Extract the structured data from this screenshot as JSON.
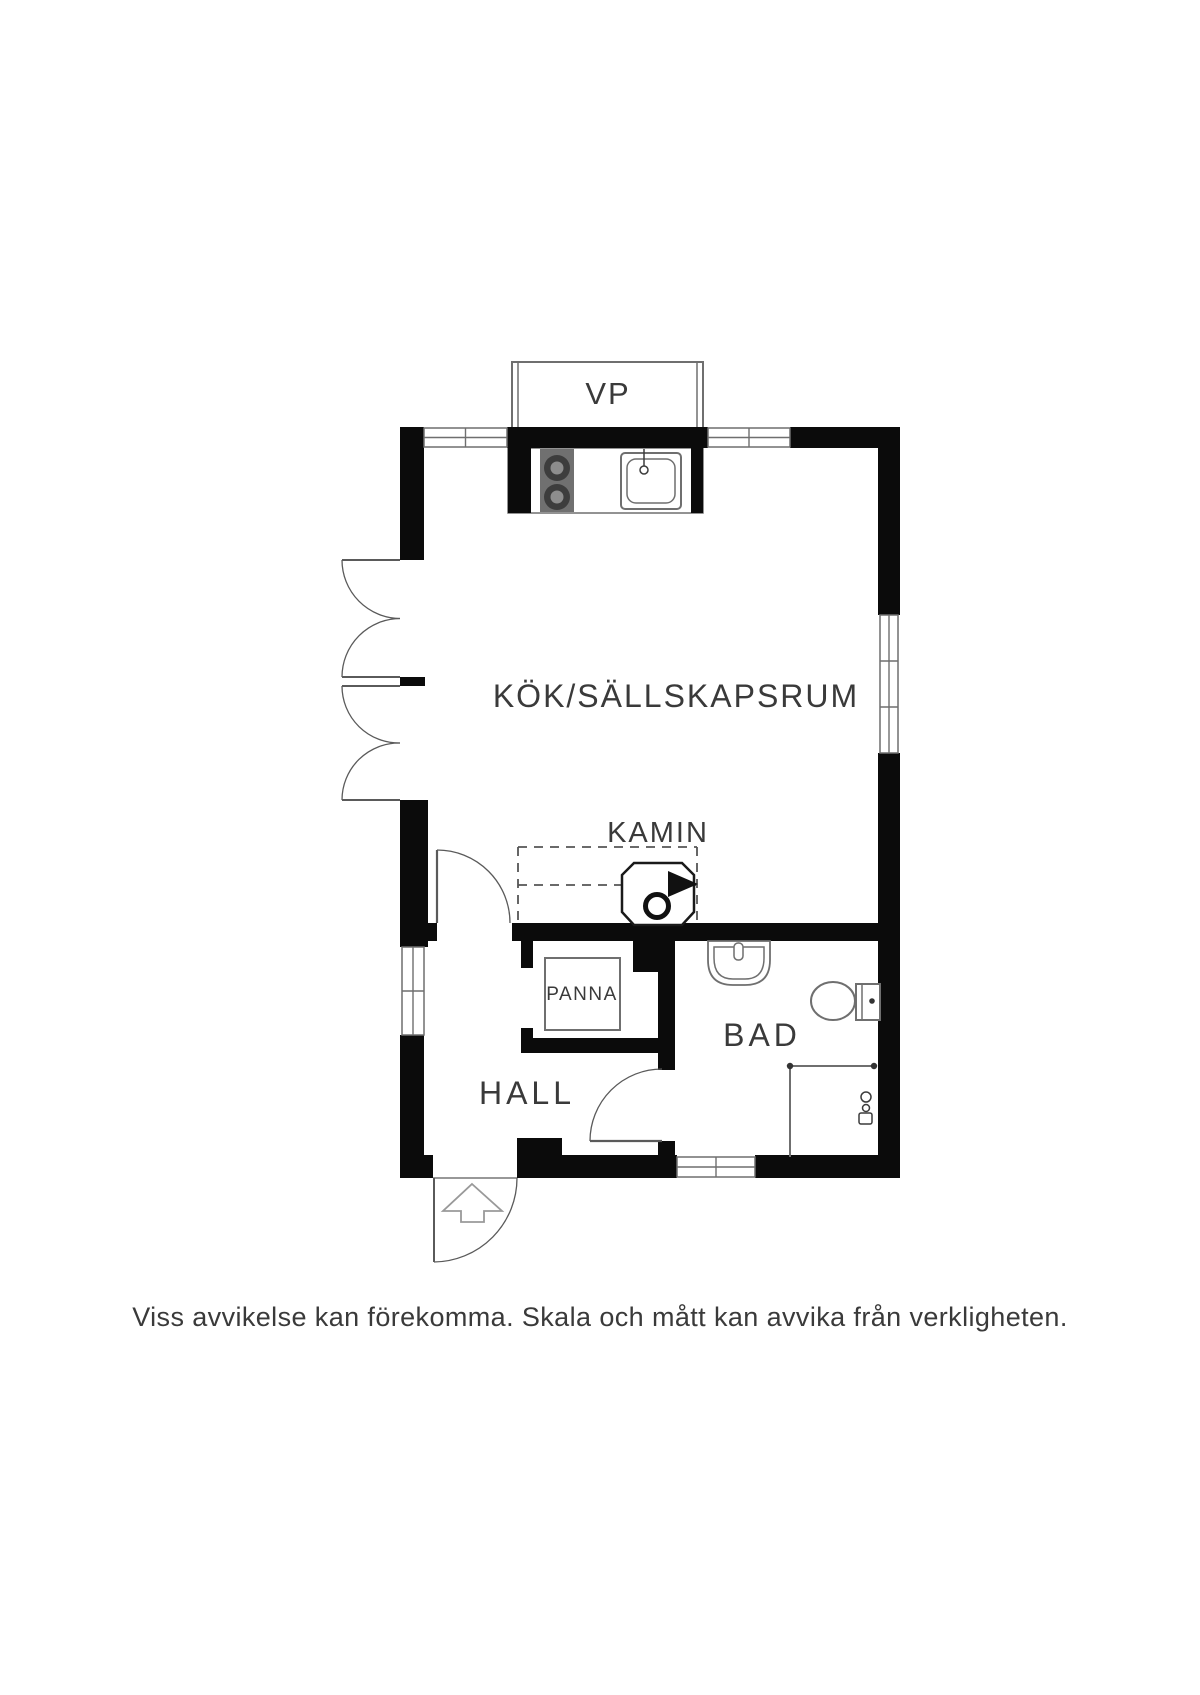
{
  "floorplan": {
    "rooms": {
      "vp": "VP",
      "kitchen_living": "KÖK/SÄLLSKAPSRUM",
      "fireplace": "KAMIN",
      "boiler": "PANNA",
      "hall": "HALL",
      "bathroom": "BAD"
    },
    "disclaimer": "Viss avvikelse kan förekomma. Skala och mått kan avvika från verkligheten."
  },
  "colors": {
    "wall": "#0b0b0b",
    "thin_line": "#6f6f6f",
    "door_line": "#5a5a5a",
    "text": "#3a3a3a",
    "background": "#ffffff",
    "stove_panel": "#707070",
    "burner_ring": "#3d3d3d",
    "burner_center": "#8d8d8d"
  }
}
